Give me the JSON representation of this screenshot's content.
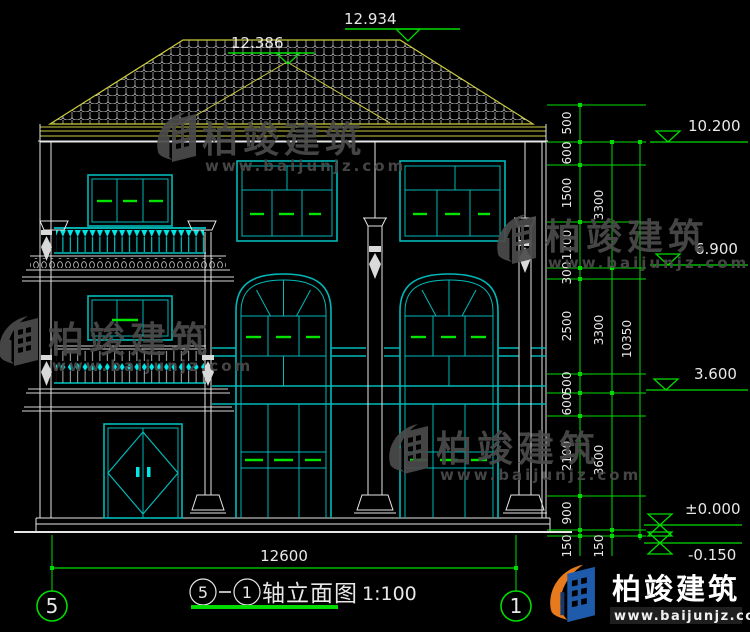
{
  "drawing": {
    "title_block": {
      "grid_left": "5",
      "grid_right": "1",
      "name": "轴立面图",
      "scale": "1:100"
    },
    "grid": {
      "left_bubble": "5",
      "right_bubble": "1"
    },
    "dims": {
      "ridge_high": "12.934",
      "ridge_low": "12.386",
      "bottom_width": "12600",
      "right_inner": [
        "500",
        "600",
        "1500",
        "1200",
        "300",
        "2500",
        "500",
        "600",
        "2100",
        "900",
        "150"
      ],
      "right_mid": [
        "3300",
        "3300",
        "3600",
        "150"
      ],
      "right_total": "10350",
      "elevations": [
        "10.200",
        "6.900",
        "3.600",
        "±0.000",
        "-0.150"
      ]
    },
    "colors": {
      "dimension_green": "#00dc00",
      "window_cyan": "#00b9b9",
      "accent_cyan": "#00e8e8",
      "roof_yellow": "#cbcb3f",
      "line_white": "#e6e6e6"
    }
  },
  "watermark": {
    "brand": "柏竣建筑",
    "url": "www.baijunjz.com"
  },
  "logo": {
    "brand": "柏竣建筑",
    "url": "www.baijunjz.com"
  }
}
